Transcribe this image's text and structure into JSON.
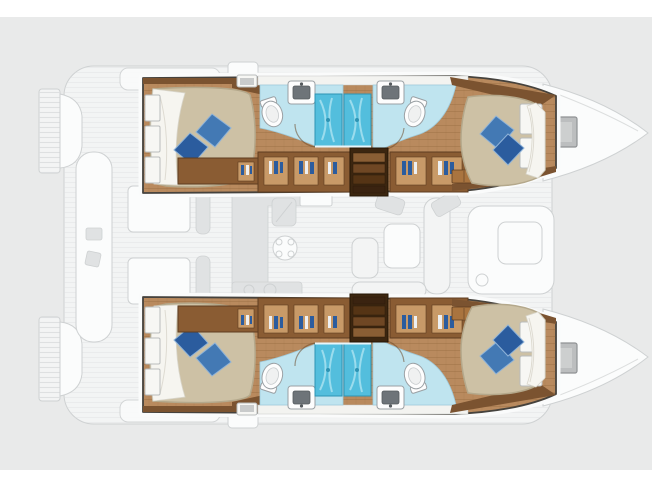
{
  "meta": {
    "description": "Top-view interior layout plan of a four-cabin sailing catamaran, bow pointing right, on a light gray canvas; no text labels are printed on the plan"
  },
  "canvas": {
    "width": 652,
    "height": 489,
    "page_background": "#ffffff",
    "plan_background": "#e9eaea",
    "white_strip_top_px": 17,
    "white_strip_bottom_px": 19
  },
  "palette": {
    "panel": "#e9eaea",
    "ghost_fill": "#f3f4f4",
    "ghost_fill_light": "#fbfcfc",
    "ghost_stroke": "#ced1d2",
    "ghost_detail": "#e0e2e3",
    "hull_outline": "#45423d",
    "hull_halo": "#fafbfb",
    "wood_floor": "#b98a5e",
    "wood_wall": "#7b5330",
    "wood_wall_dark": "#5e3d20",
    "wood_shelf": "#a9743f",
    "cabinet": "#8a5c33",
    "cabinet_opening": "#c89a68",
    "steps_frame": "#3c2610",
    "steps_tread_light": "#8a5e34",
    "steps_tread_mid": "#6f4724",
    "steps_tread_dark": "#553415",
    "bed_cover": "#cdc1a5",
    "bed_shadow": "#b4a88b",
    "bed_sheet": "#f6f5f0",
    "pillow_light": "#4379b4",
    "pillow_dark": "#2b5c9e",
    "pillow_edge": "#8fb3d8",
    "bath_floor": "#bfe4ef",
    "shower_blue": "#53bedd",
    "shower_streak": "#a8e2f0",
    "fixture_white": "#fdfdfd",
    "fixture_stroke": "#9aa0a4",
    "window_white": "#f7f7f4",
    "window_stroke": "#b9bcbd",
    "hatch_gray": "#bcbebf",
    "cloth_blue": "#2b5c9e",
    "cloth_white": "#eef0f2"
  },
  "vessel": {
    "type": "catamaran",
    "orientation": "bow-right",
    "hulls": [
      {
        "id": "top-hull",
        "aria": "Top hull: aft double cabin, two shower bathrooms, wardrobes, companionway steps and forward double cabin"
      },
      {
        "id": "bottom-hull",
        "aria": "Bottom hull: mirrored layout of the top hull"
      }
    ],
    "rooms": {
      "aft_cabin": "Aft double cabin with island bed and two blue pillows",
      "forward_cabin": "Forward double cabin with island bed and two blue pillows",
      "aft_bathroom": "Aft bathroom with toilet, washbasin and shower stall",
      "forward_bathroom": "Forward bathroom with washbasin, toilet and shower stall",
      "companionway": "Companionway steps down from the saloon",
      "wardrobes": "Wardrobe and stowage cabinets with hanging clothes",
      "saloon": "Saloon with galley, dinette and forward seating, shown ghosted",
      "cockpit": "Aft cockpit with bench seats and tables, shown ghosted",
      "bow": "Ghosted bow deck with gray deck hatch",
      "transom": "Ghosted transom swim platform steps"
    },
    "counts": {
      "cabins": 4,
      "bathrooms": 4,
      "showers": 4,
      "toilets": 4,
      "washbasins": 4,
      "double_beds": 4,
      "blue_pillows": 8,
      "companionway_stairs": 2,
      "bow_deck_hatches": 2
    }
  }
}
